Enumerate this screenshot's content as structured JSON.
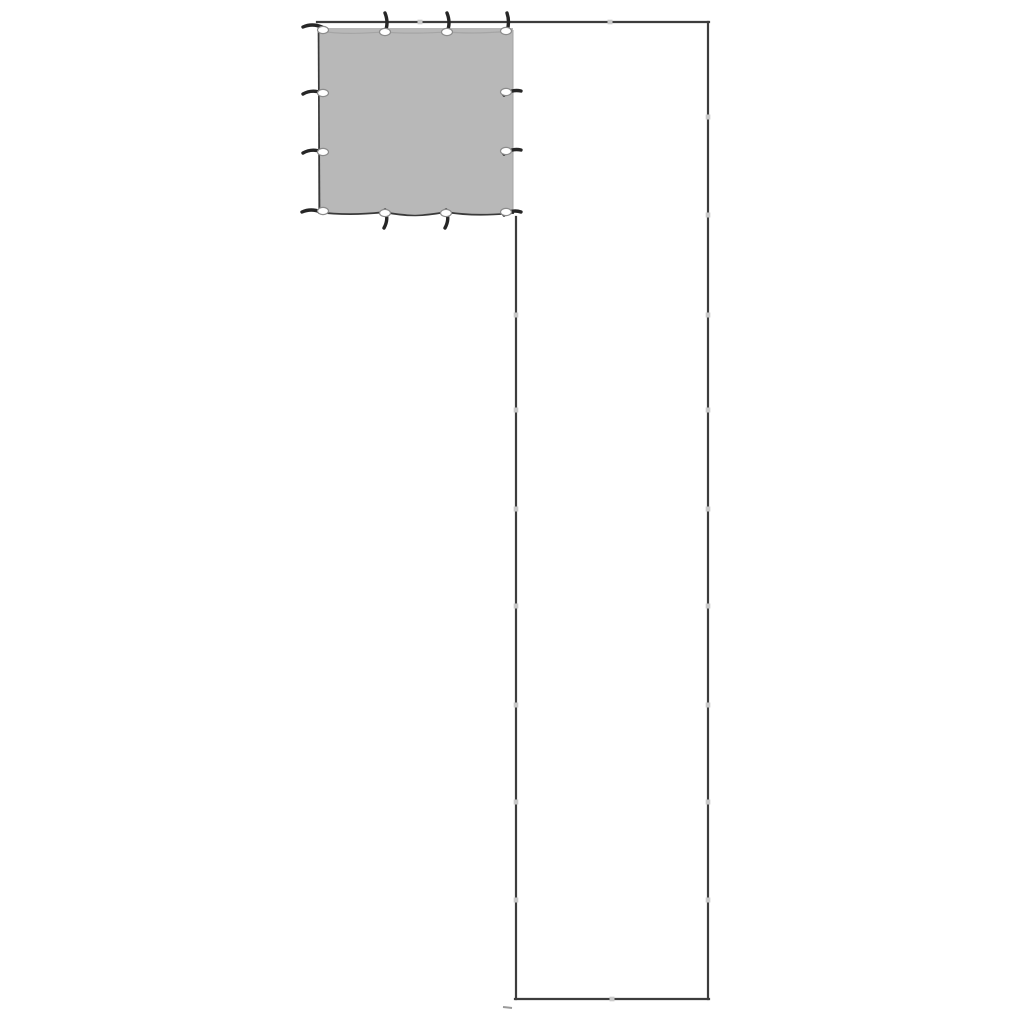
{
  "illustration": {
    "subject": "Gray square tarp with eyelets and hooks mounted on a tall narrow sectioned pole frame",
    "background_color": "#ffffff"
  },
  "colors": {
    "background": "#ffffff",
    "tarp_fill": "#b8b8b8",
    "tarp_edge": "#3a3a3a",
    "tarp_edge_soft": "#a5a5a5",
    "frame": "#3d3d3d",
    "joint": "#c9c9c9",
    "hook": "#262626",
    "grommet_fill": "#ffffff",
    "grommet_stroke": "#8c8c8c",
    "foot_mark": "#9a9a9a"
  },
  "counts": {
    "grommets": 12,
    "hooks": 12,
    "right_pole_joints": 9,
    "inner_pole_joints": 7,
    "top_bar_joints": 2,
    "bottom_bar_joints": 1
  }
}
